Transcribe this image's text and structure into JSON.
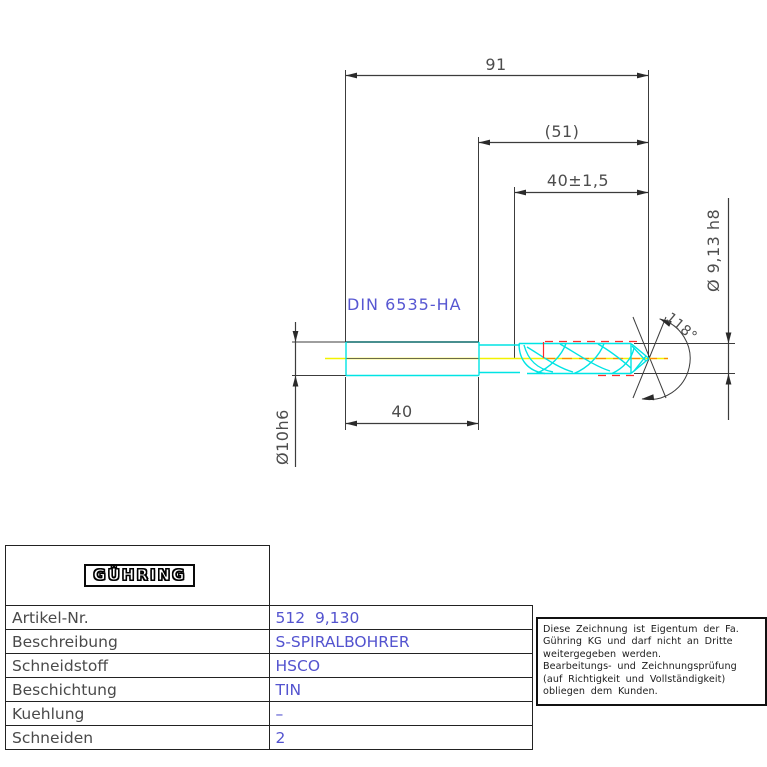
{
  "drawing": {
    "standard_label": "DIN 6535-HA",
    "dim_overall_length": "91",
    "dim_ref_length": "(51)",
    "dim_flute_length": "40±1,5",
    "dim_shank_length": "40",
    "dim_shank_diameter": "Ø10h6",
    "dim_point_diameter": "Ø 9,13 h8",
    "dim_point_angle": "118°",
    "colors": {
      "outline_cyan": "#00e4e4",
      "outline_dark_teal": "#0c6a6a",
      "centerline_yellow": "#f2f200",
      "margin_red": "#ff2a2a",
      "center_dash_orange": "#ff8800",
      "dimension_gray": "#3c3c3c",
      "text_gray": "#4d4d4d",
      "text_blue": "#5757d2"
    }
  },
  "title_block": {
    "logo_text": "GÜHRING",
    "rows": [
      {
        "label": "Artikel-Nr.",
        "value": "512  9,130"
      },
      {
        "label": "Beschreibung",
        "value": "S-SPIRALBOHRER"
      },
      {
        "label": "Schneidstoff",
        "value": "HSCO"
      },
      {
        "label": "Beschichtung",
        "value": "TIN"
      },
      {
        "label": "Kuehlung",
        "value": "–"
      },
      {
        "label": "Schneiden",
        "value": "2"
      }
    ]
  },
  "notice": {
    "lines": [
      "Diese Zeichnung ist Eigentum der Fa.",
      "Gühring KG und darf nicht an Dritte",
      "weitergegeben werden.",
      "Bearbeitungs- und Zeichnungsprüfung",
      "(auf Richtigkeit und Vollständigkeit)",
      "obliegen dem Kunden."
    ]
  }
}
